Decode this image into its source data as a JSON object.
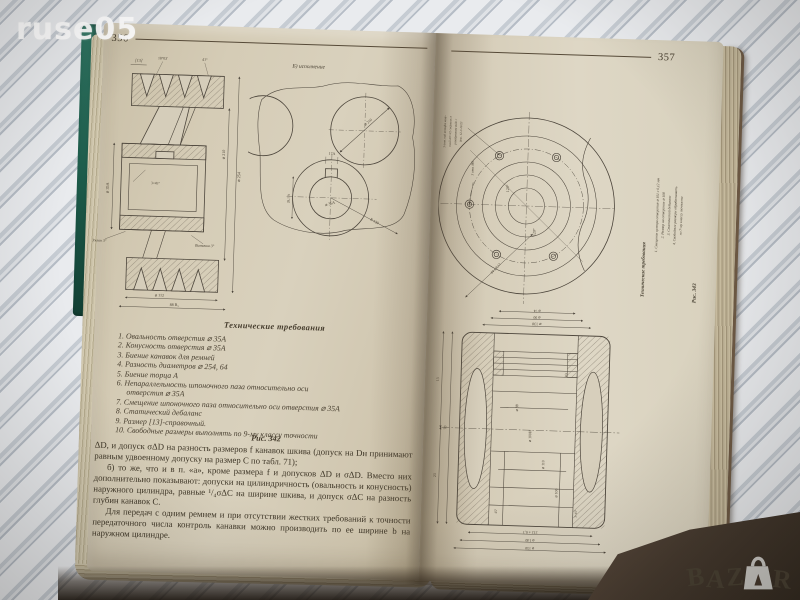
{
  "photo": {
    "watermark_top_left": "ruse05",
    "bazar_letters": [
      "B",
      "A",
      "Z",
      "R"
    ]
  },
  "left_page": {
    "page_number": "356",
    "pulley_labels": [
      "[13]",
      "18°03'",
      "41°",
      "⌀ 35А",
      "⌀ 210",
      "⌀ 254",
      "3×45°",
      "Уклон 3°",
      "Выточка 3°",
      "⌀ 112",
      "88 В₃"
    ],
    "detail_caption": "Б) исполнение",
    "detail_labels": [
      "⌀ 210",
      "17А",
      "⌀ 35А",
      "R 130",
      "28,1 А"
    ],
    "tech_heading": "Технические требования",
    "tech_items": [
      "1. Овальность отверстия ⌀ 35А",
      "2. Конусность отверстия ⌀ 35А",
      "3. Биение канавок для ремней",
      "4. Разность диаметров ⌀ 254, 64",
      "5. Биение торца А",
      "6. Непараллельность шпоночного паза относительно оси отверстия ⌀ 35А",
      "7. Смещение шпоночного паза относительно оси отверстия ⌀ 35А",
      "8. Статический дебаланс",
      "9. Размер [13]-справочный.",
      "10. Свободные размеры выполнять по 9-му классу точности"
    ],
    "figure_caption": "Рис. 342",
    "paragraphs": [
      "ΔD, и допуск σΔD на разность размеров f канавок шкива (допуск на Dн принимают равным удвоенному допуску на размер С по табл. 71);",
      "б) то же, что и в п. «а», кроме размера f и допусков ΔD и σΔD. Вместо них дополнительно показывают: допуски на цилиндричность (овальность и конусность) наружного цилиндра, равные ¹/₄σΔС на ширине шкива, и допуск σΔС на разность глубин канавок С.",
      "Для передач с одним ремнем и при отсутствии жестких требований к точности передаточного числа контроль канавки можно производить по ее ширине b на наружном цилиндре."
    ]
  },
  "right_page": {
    "page_number": "357",
    "flange": {
      "note1": [
        "3 отв. под штифт кону-",
        "сный ⌀3×22 сверлить в",
        "разобранном виде с",
        "дет. 12-3-10/23"
      ],
      "note2": "3 отв. М6",
      "labels": [
        "120°",
        "120°",
        "84 ± 0,12"
      ]
    },
    "cylinder": {
      "labels": [
        "⌀ 130",
        "⌀ 90",
        "⌀ 74",
        "⌀ 88",
        "⌀ 100Н",
        "⌀ 110",
        "R3",
        "45°",
        "3×45°",
        "212 ± 0,1",
        "⌀ 140",
        "⌀ 150",
        "70",
        "13",
        "23",
        "⌀ 106"
      ]
    },
    "tech_heading": "Технические требования",
    "tech_items": [
      "1. Смещение центра отверстия ⌀ 101 с 0,12 мм",
      "2. Размер на отверстие ⌀ 108",
      "3. Статический дебаланс",
      "4. Свободные размеры обрабатывать",
      "по 7-му классу точности"
    ],
    "figure_caption": "Рис. 343"
  }
}
